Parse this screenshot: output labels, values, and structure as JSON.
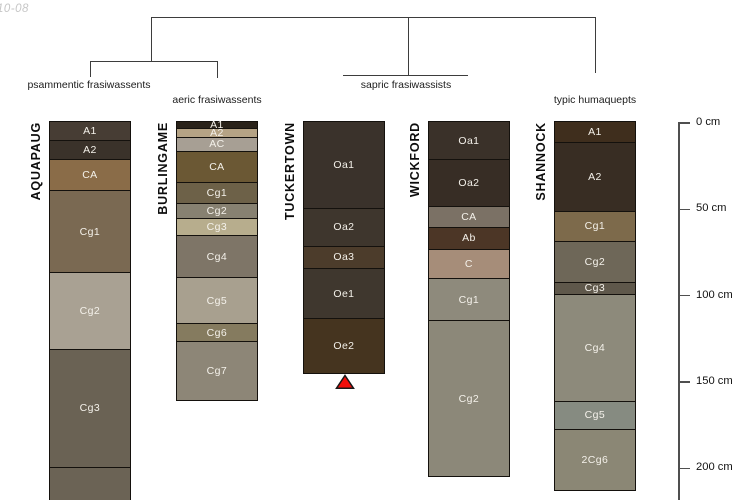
{
  "watermark": "10-08",
  "figure": "soil profile classification dendrogram",
  "taxonomy_groups": [
    {
      "label": "psammentic frasiwassents",
      "profiles": [
        "AQUAPAUG"
      ]
    },
    {
      "label": "aeric frasiwassents",
      "profiles": [
        "BURLINGAME"
      ]
    },
    {
      "label": "sapric frasiwassists",
      "profiles": [
        "TUCKERTOWN",
        "WICKFORD"
      ]
    },
    {
      "label": "typic humaquepts",
      "profiles": [
        "SHANNOCK"
      ]
    }
  ],
  "depth_scale": {
    "unit": "cm",
    "ticks": [
      {
        "label": "0 cm",
        "cm": 0
      },
      {
        "label": "50 cm",
        "cm": 50
      },
      {
        "label": "100 cm",
        "cm": 100
      },
      {
        "label": "150 cm",
        "cm": 150
      },
      {
        "label": "200 cm",
        "cm": 200
      }
    ]
  },
  "profiles": [
    {
      "name": "AQUAPAUG",
      "group": "psammentic frasiwassents",
      "open_bottom": true,
      "horizons": [
        {
          "label": "A1",
          "color": "#473d34",
          "top_cm": 0,
          "bottom_cm": 11
        },
        {
          "label": "A2",
          "color": "#3a322a",
          "top_cm": 11,
          "bottom_cm": 22
        },
        {
          "label": "CA",
          "color": "#8a6c48",
          "top_cm": 22,
          "bottom_cm": 40
        },
        {
          "label": "Cg1",
          "color": "#7a6952",
          "top_cm": 40,
          "bottom_cm": 87
        },
        {
          "label": "Cg2",
          "color": "#a9a193",
          "top_cm": 87,
          "bottom_cm": 132
        },
        {
          "label": "Cg3",
          "color": "#6a6254",
          "top_cm": 132,
          "bottom_cm": 200
        },
        {
          "label": "",
          "color": "#6b6355",
          "top_cm": 200,
          "bottom_cm": 219
        }
      ]
    },
    {
      "name": "BURLINGAME",
      "group": "aeric frasiwassents",
      "open_bottom": false,
      "horizons": [
        {
          "label": "A1",
          "color": "#292219",
          "top_cm": 0,
          "bottom_cm": 4
        },
        {
          "label": "A2",
          "color": "#b5a385",
          "top_cm": 4,
          "bottom_cm": 9
        },
        {
          "label": "AC",
          "color": "#a79f94",
          "top_cm": 9,
          "bottom_cm": 17
        },
        {
          "label": "CA",
          "color": "#6b5834",
          "top_cm": 17,
          "bottom_cm": 35
        },
        {
          "label": "Cg1",
          "color": "#6d6148",
          "top_cm": 35,
          "bottom_cm": 47
        },
        {
          "label": "Cg2",
          "color": "#878171",
          "top_cm": 47,
          "bottom_cm": 56
        },
        {
          "label": "Cg3",
          "color": "#b7ad8d",
          "top_cm": 56,
          "bottom_cm": 66
        },
        {
          "label": "Cg4",
          "color": "#7e7567",
          "top_cm": 66,
          "bottom_cm": 90
        },
        {
          "label": "Cg5",
          "color": "#a8a08f",
          "top_cm": 90,
          "bottom_cm": 117
        },
        {
          "label": "Cg6",
          "color": "#857b5f",
          "top_cm": 117,
          "bottom_cm": 127
        },
        {
          "label": "Cg7",
          "color": "#8d8677",
          "top_cm": 127,
          "bottom_cm": 161
        }
      ]
    },
    {
      "name": "TUCKERTOWN",
      "group": "sapric frasiwassists",
      "open_bottom": false,
      "horizons": [
        {
          "label": "Oa1",
          "color": "#3a322b",
          "top_cm": 0,
          "bottom_cm": 50
        },
        {
          "label": "Oa2",
          "color": "#3e362d",
          "top_cm": 50,
          "bottom_cm": 72
        },
        {
          "label": "Oa3",
          "color": "#4c3c2b",
          "top_cm": 72,
          "bottom_cm": 85
        },
        {
          "label": "Oe1",
          "color": "#3f372e",
          "top_cm": 85,
          "bottom_cm": 114
        },
        {
          "label": "Oe2",
          "color": "#45341f",
          "top_cm": 114,
          "bottom_cm": 145
        }
      ]
    },
    {
      "name": "WICKFORD",
      "group": "sapric frasiwassists",
      "open_bottom": false,
      "horizons": [
        {
          "label": "Oa1",
          "color": "#3a3129",
          "top_cm": 0,
          "bottom_cm": 22
        },
        {
          "label": "Oa2",
          "color": "#372d25",
          "top_cm": 22,
          "bottom_cm": 49
        },
        {
          "label": "CA",
          "color": "#7b7165",
          "top_cm": 49,
          "bottom_cm": 61
        },
        {
          "label": "Ab",
          "color": "#4c3626",
          "top_cm": 61,
          "bottom_cm": 74
        },
        {
          "label": "C",
          "color": "#a68d79",
          "top_cm": 74,
          "bottom_cm": 91
        },
        {
          "label": "Cg1",
          "color": "#8e8a7c",
          "top_cm": 91,
          "bottom_cm": 115
        },
        {
          "label": "Cg2",
          "color": "#8c8879",
          "top_cm": 115,
          "bottom_cm": 205
        }
      ]
    },
    {
      "name": "SHANNOCK",
      "group": "typic humaquepts",
      "open_bottom": false,
      "horizons": [
        {
          "label": "A1",
          "color": "#3f2e1d",
          "top_cm": 0,
          "bottom_cm": 12
        },
        {
          "label": "A2",
          "color": "#382d23",
          "top_cm": 12,
          "bottom_cm": 52
        },
        {
          "label": "Cg1",
          "color": "#7d6a4b",
          "top_cm": 52,
          "bottom_cm": 69
        },
        {
          "label": "Cg2",
          "color": "#6e6758",
          "top_cm": 69,
          "bottom_cm": 93
        },
        {
          "label": "Cg3",
          "color": "#5f584b",
          "top_cm": 93,
          "bottom_cm": 100
        },
        {
          "label": "Cg4",
          "color": "#8d8a7b",
          "top_cm": 100,
          "bottom_cm": 162
        },
        {
          "label": "Cg5",
          "color": "#868b81",
          "top_cm": 162,
          "bottom_cm": 178
        },
        {
          "label": "2Cg6",
          "color": "#8b8775",
          "top_cm": 178,
          "bottom_cm": 213
        }
      ]
    }
  ],
  "marker": {
    "symbol": "triangle-up",
    "color": "#f10e0a",
    "under_profile": "TUCKERTOWN"
  }
}
